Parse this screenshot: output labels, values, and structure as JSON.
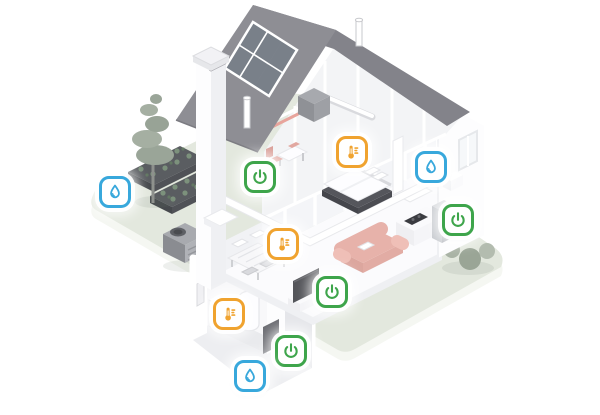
{
  "canvas": {
    "width": 600,
    "height": 415,
    "background": "#FFFFFF"
  },
  "palette": {
    "badge_green": "#3EA54B",
    "badge_orange": "#F0A32F",
    "badge_blue": "#38A8DC",
    "badge_bg": "#FFFFFF",
    "roof_left": "#8E8E94",
    "roof_right": "#83838A",
    "solar_cell": "#798089",
    "wall_white": "#FDFDFE",
    "wall_shade": "#EFF0F3",
    "interior_wall": "#F4F5F8",
    "ground": "#E3E8DE",
    "ground_side": "#F5F7F2",
    "sofa": "#E7B2AA",
    "chair": "#E2A8A1",
    "tree": "#9AA598",
    "bush": "#A9B3A5",
    "dark_gray": "#55565C"
  },
  "icon_names": {
    "power": "power-icon",
    "thermometer": "thermometer-icon",
    "water": "water-drop-icon"
  },
  "badges": [
    {
      "id": "garden-irrigation-water",
      "type": "water",
      "x": 115,
      "y": 192
    },
    {
      "id": "bedroom-power",
      "type": "power",
      "x": 260,
      "y": 177
    },
    {
      "id": "bedroom-thermostat",
      "type": "thermometer",
      "x": 352,
      "y": 152
    },
    {
      "id": "bathroom-water",
      "type": "water",
      "x": 431,
      "y": 167
    },
    {
      "id": "kitchen-power",
      "type": "power",
      "x": 458,
      "y": 220
    },
    {
      "id": "dining-thermostat",
      "type": "thermometer",
      "x": 283,
      "y": 244
    },
    {
      "id": "living-room-power",
      "type": "power",
      "x": 332,
      "y": 292
    },
    {
      "id": "basement-thermostat",
      "type": "thermometer",
      "x": 229,
      "y": 314
    },
    {
      "id": "basement-power",
      "type": "power",
      "x": 291,
      "y": 351
    },
    {
      "id": "basement-water",
      "type": "water",
      "x": 250,
      "y": 376
    }
  ]
}
